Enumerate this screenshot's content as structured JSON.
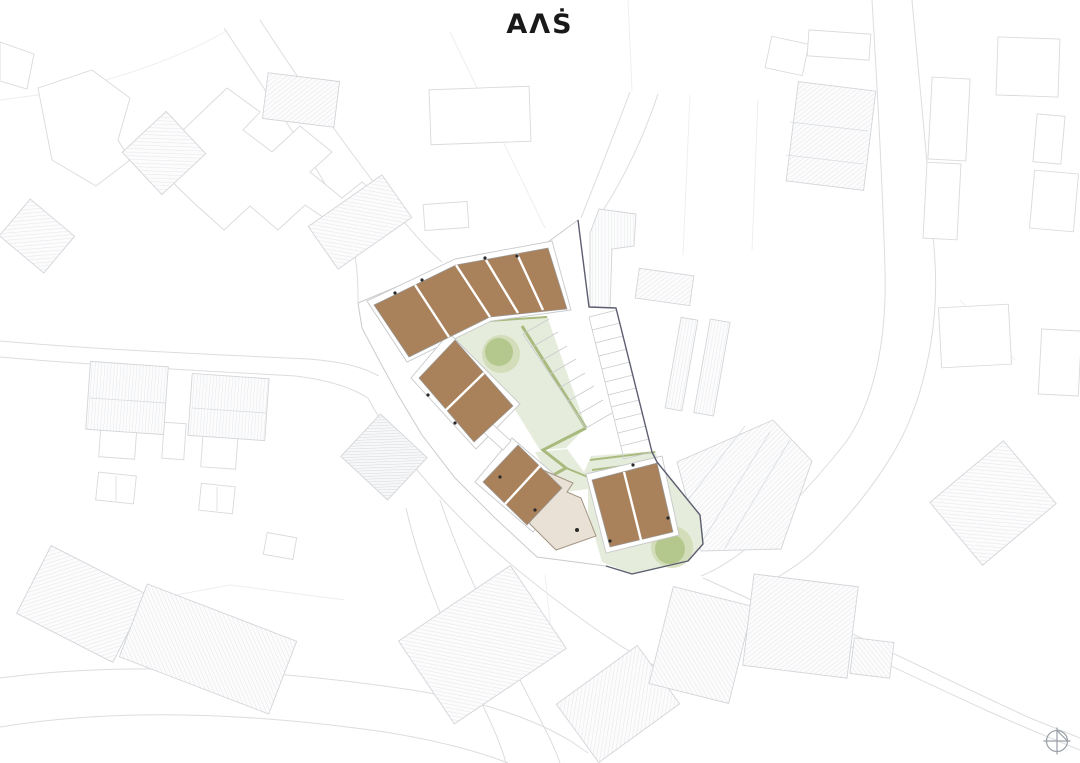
{
  "meta": {
    "drawing_type": "architectural-site-plan",
    "orientation_icon": "north-arrow"
  },
  "logo": {
    "text": "AɅṠ"
  },
  "colors": {
    "background": "#ffffff",
    "proposed_building": "#a9815b",
    "proposed_building_edge": "#9a9a9a",
    "existing_building_keep": "#e9e1d6",
    "existing_building_edge": "#a39582",
    "green_area": "#e6ecdb",
    "green_path": "#a9ba7e",
    "tree": "#b4c88e",
    "tree_halo": "#ccd8ae",
    "boundary_line": "#5d5e70",
    "marker": "#2a2a2a",
    "compass": "#9aa0a6",
    "logo_text": "#191919"
  },
  "site": {
    "proposed_clusters": [
      {
        "name": "north-row",
        "units": 5
      },
      {
        "name": "west-upper-pair",
        "units": 2
      },
      {
        "name": "west-lower-pair",
        "units": 2
      },
      {
        "name": "south-east-pair",
        "units": 2
      }
    ],
    "total_proposed_units": 11,
    "existing_buildings": [
      {
        "name": "beige-building",
        "units": 1
      }
    ],
    "landscape": {
      "courtyard_trees": 2,
      "green_areas": 3,
      "green_paths": true
    },
    "parking": {
      "rows": 2,
      "stalls_west_row": 7,
      "stalls_east_row": 11
    },
    "entrance_markers": 12
  },
  "context": {
    "hatched_buildings": 19,
    "outline_buildings": 16,
    "roads_visible": true
  }
}
